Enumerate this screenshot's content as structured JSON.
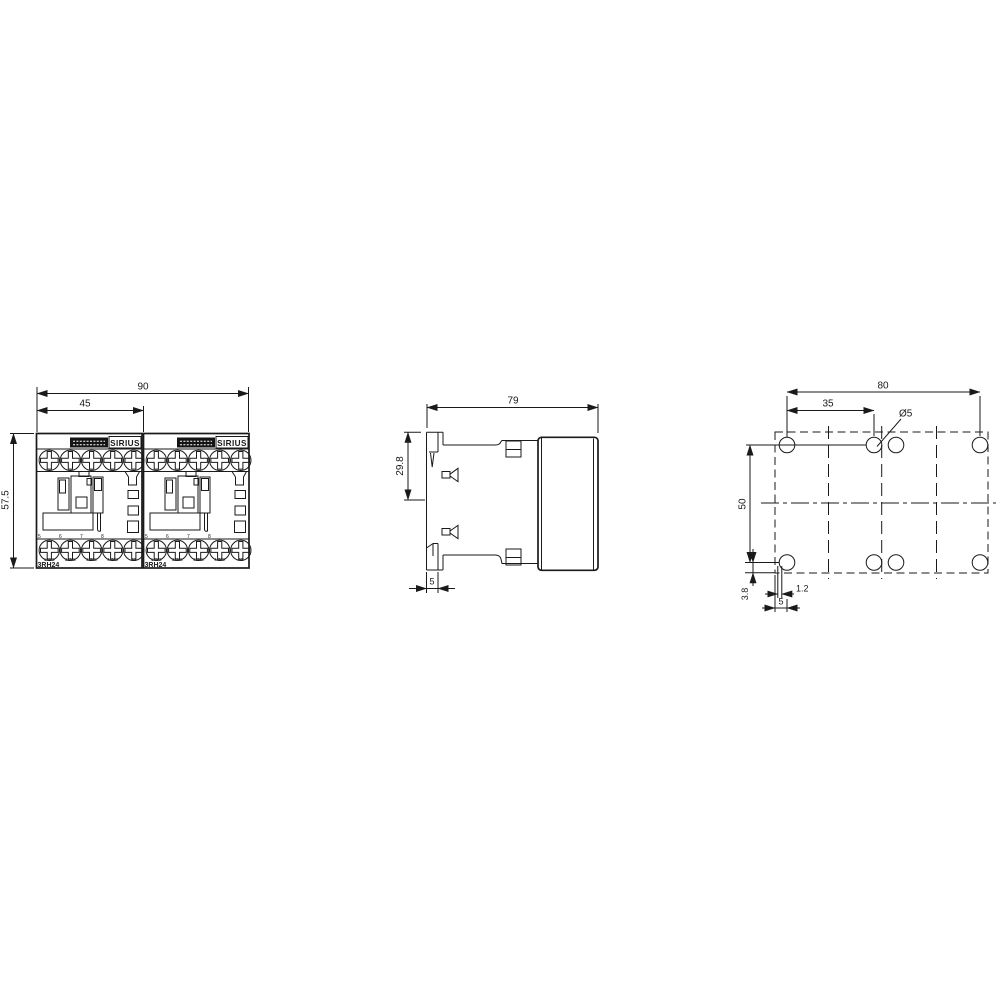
{
  "front_view": {
    "dim_total_width": "90",
    "dim_module_width": "45",
    "dim_height": "57.5",
    "module": {
      "brand": "SIRIUS",
      "type": "3RH24"
    },
    "terminal_numbers": [
      "5",
      "6",
      "7",
      "8"
    ],
    "terminal_labels": [
      "14NO",
      "22NC",
      "32NC",
      "44NO",
      "A2"
    ]
  },
  "side_view": {
    "dim_depth": "79",
    "dim_clip_height": "29.8",
    "dim_rail_width": "5"
  },
  "drilling_plan": {
    "dim_hole_span_width": "80",
    "dim_module_span": "35",
    "hole_diameter": "Ø5",
    "dim_hole_span_height": "50",
    "dim_bottom_edge_offset": "3.8",
    "dim_slot_width": "1.2",
    "dim_left_edge_offset": "5"
  },
  "colors": {
    "line": "#1a1a1a",
    "background": "#ffffff"
  }
}
